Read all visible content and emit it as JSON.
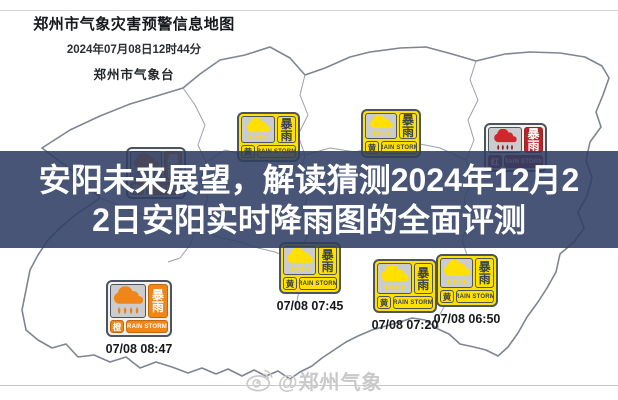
{
  "header": {
    "title": "郑州市气象灾害预警信息地图",
    "datetime": "2024年07月08日12时44分",
    "issuer": "郑州市气象台"
  },
  "title_overlay": {
    "line1": "安阳未来展望，解读猜测2024年12月2",
    "line2": "2日安阳实时降雨图的全面评测",
    "background": "#2f3d63",
    "text_color": "#ffffff"
  },
  "watermark": {
    "text": "@郑州气象",
    "icon": "weibo-logo-icon",
    "color": "#c9c9c9"
  },
  "warning_type": {
    "cn": "暴雨",
    "en": "RAIN STORM"
  },
  "levels": {
    "yellow": {
      "name": "黄",
      "frame_bg": "#ffe000",
      "cloud": "#ffe000",
      "drops": "#ffdb00",
      "type_bg": "#ffe000",
      "type_color": "#3a434d",
      "cell_border": "#4b545f"
    },
    "orange": {
      "name": "橙",
      "frame_bg": "#f5f3ef",
      "cloud": "#f08519",
      "drops": "#ef7f12",
      "type_bg": "#f08519",
      "type_color": "#ffffff",
      "cell_border": "#c4690a"
    },
    "red": {
      "name": "红",
      "frame_bg": "#f5f3ef",
      "cloud": "#d0262c",
      "drops": "#8e1f29",
      "type_bg": "#b6252e",
      "type_color": "#ffffff",
      "cell_border": "#9e2026"
    }
  },
  "warnings": [
    {
      "level": "orange",
      "x": 126,
      "y": 147,
      "w": 60,
      "h": 52,
      "timestamp": null
    },
    {
      "level": "yellow",
      "x": 237,
      "y": 112,
      "w": 63,
      "h": 50,
      "timestamp": null
    },
    {
      "level": "yellow",
      "x": 361,
      "y": 109,
      "w": 60,
      "h": 49,
      "timestamp": null
    },
    {
      "level": "red",
      "x": 484,
      "y": 123,
      "w": 63,
      "h": 49,
      "timestamp": null
    },
    {
      "level": "orange",
      "x": 106,
      "y": 280,
      "w": 66,
      "h": 57,
      "timestamp": "07/08 08:47"
    },
    {
      "level": "yellow",
      "x": 279,
      "y": 242,
      "w": 62,
      "h": 52,
      "timestamp": "07/08 07:45"
    },
    {
      "level": "yellow",
      "x": 373,
      "y": 259,
      "w": 64,
      "h": 54,
      "timestamp": "07/08 07:20"
    },
    {
      "level": "yellow",
      "x": 436,
      "y": 254,
      "w": 62,
      "h": 53,
      "timestamp": "07/08 06:50"
    }
  ]
}
